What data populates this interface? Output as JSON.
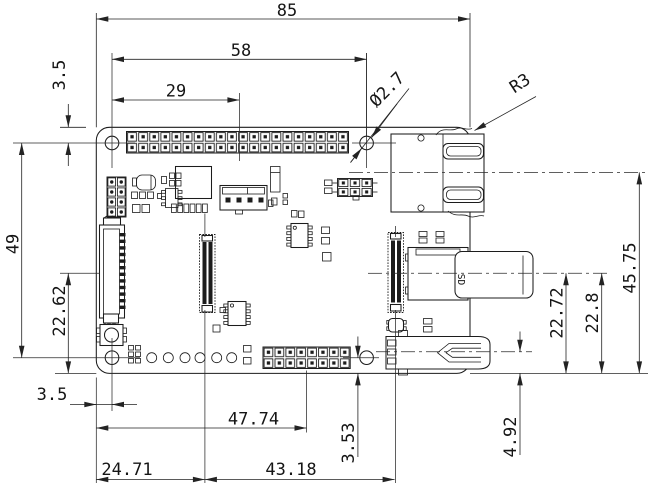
{
  "drawing": {
    "type": "pcb-mechanical-dimension-drawing",
    "units": "mm",
    "dims": {
      "overall_width": "85",
      "hole_span_x": "58",
      "half_span": "29",
      "hole_top_offset": "3.5",
      "hole_diameter": "Ø2.7",
      "corner_radius": "R3",
      "hole_span_y": "49",
      "dsi_center_from_bottom": "22.62",
      "hole_left_offset": "3.5",
      "header_center_from_left": "47.74",
      "camera_center_from_left": "24.71",
      "right_conn_from_camera": "43.18",
      "header_center_from_bottom": "3.53",
      "usb_center_from_bottom": "4.92",
      "sd_center_from_bottom_a": "22.72",
      "sd_center_from_bottom_b": "22.8",
      "ethernet_center_from_bottom": "45.75"
    },
    "labels": {
      "sd_card": "SD"
    }
  }
}
